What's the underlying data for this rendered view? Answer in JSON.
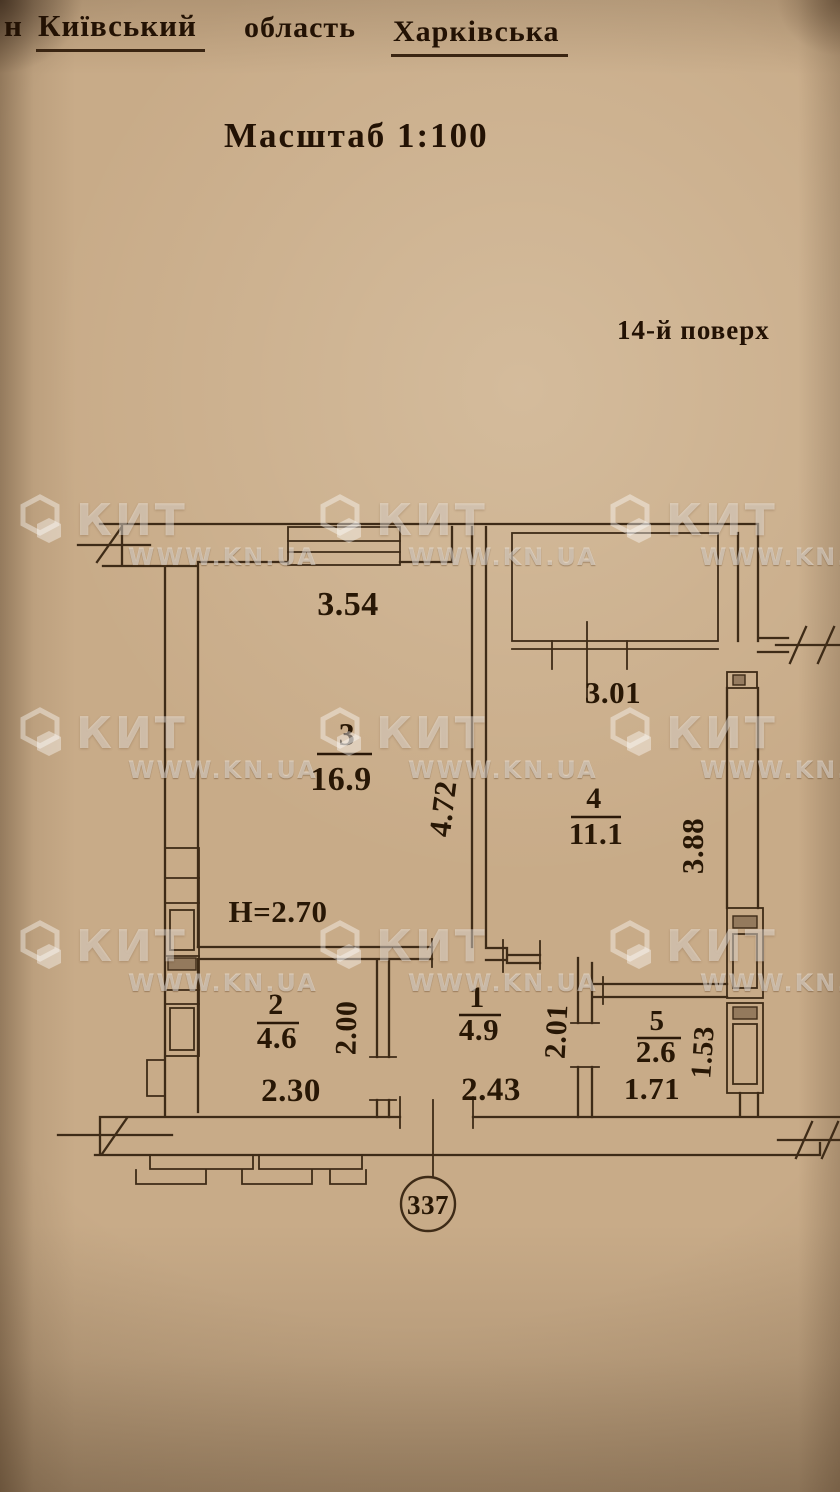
{
  "document": {
    "header": {
      "fragment": "н",
      "district": "Київський",
      "region_label": "область",
      "region_value": "Харківська"
    },
    "scale_label": "Масштаб 1:100",
    "floor_label": "14-й поверх",
    "apartment_number": "337",
    "ceiling_height": "Н=2.70"
  },
  "floor_plan": {
    "rooms": [
      {
        "id": "1",
        "area": "4.9"
      },
      {
        "id": "2",
        "area": "4.6"
      },
      {
        "id": "3",
        "area": "16.9"
      },
      {
        "id": "4",
        "area": "11.1"
      },
      {
        "id": "5",
        "area": "2.6"
      }
    ],
    "dimensions": {
      "room3_width": "3.54",
      "room3_depth": "4.72",
      "room4_width": "3.01",
      "room4_depth": "3.88",
      "room2_width": "2.30",
      "room2_depth": "2.00",
      "room1_width": "2.43",
      "room1_depth": "2.01",
      "room5_width": "1.71",
      "room5_depth": "1.53"
    }
  },
  "watermark": {
    "brand": "КИТ",
    "url": "WWW.KN.UA"
  },
  "colors": {
    "paper": "#c8ab88",
    "ink": "#3e2b17",
    "text": "#281705",
    "watermark": "rgba(255,255,255,0.42)"
  }
}
